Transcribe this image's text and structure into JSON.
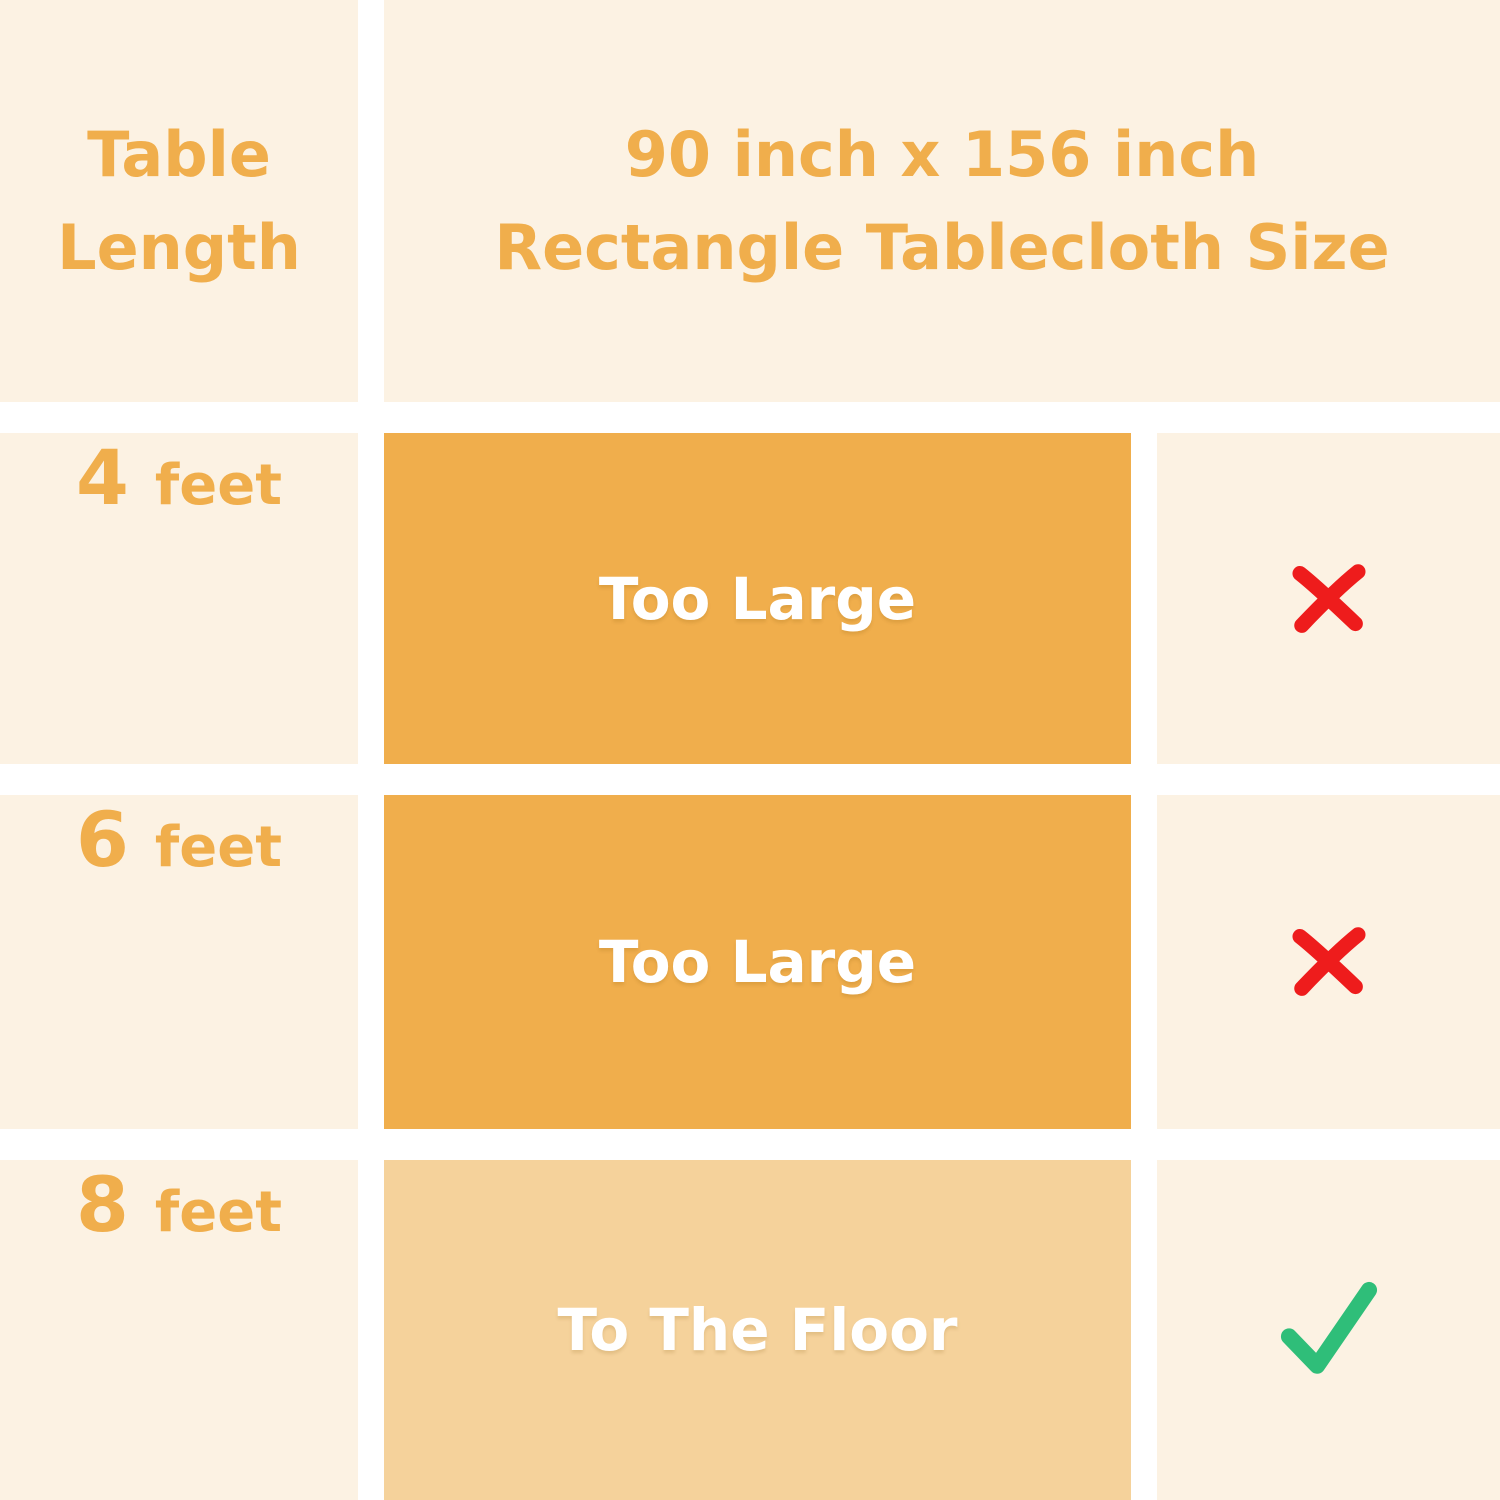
{
  "colors": {
    "cream": "#FCF2E3",
    "orange": "#F0AE4C",
    "orange-light": "#F5D29B",
    "red": "#EE1C1C",
    "green": "#2FBE79",
    "gap-white": "#FFFFFF",
    "text-white": "#FFFFFF"
  },
  "header": {
    "left_line1": "Table",
    "left_line2": "Length",
    "title_line1": "90 inch x 156 inch",
    "title_line2": "Rectangle Tablecloth Size"
  },
  "rows": [
    {
      "length_value": "4",
      "length_unit": "feet",
      "fit_label": "Too Large",
      "result": "not-suitable",
      "result_icon": "x-mark-icon"
    },
    {
      "length_value": "6",
      "length_unit": "feet",
      "fit_label": "Too Large",
      "result": "not-suitable",
      "result_icon": "x-mark-icon"
    },
    {
      "length_value": "8",
      "length_unit": "feet",
      "fit_label": "To The Floor",
      "result": "suitable",
      "result_icon": "check-mark-icon"
    }
  ]
}
